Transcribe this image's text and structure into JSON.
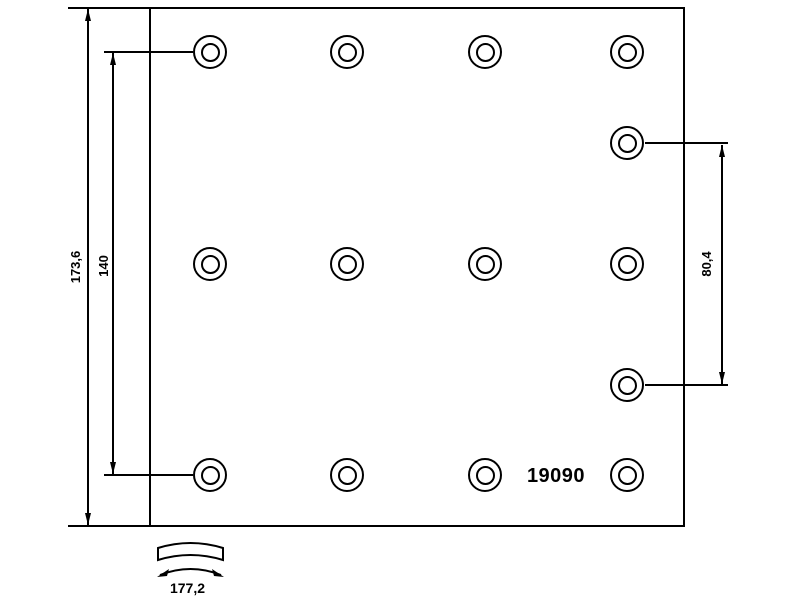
{
  "drawing": {
    "type": "brake-lining-technical-drawing",
    "part_number": "19090",
    "dimensions": {
      "overall_height": "173,6",
      "hole_span_vertical": "140",
      "right_hole_span": "80,4",
      "arc_length": "177,2"
    },
    "colors": {
      "line": "#000000",
      "background": "#ffffff"
    },
    "hole_outer_diameter_px": 34,
    "hole_inner_diameter_px": 19,
    "holes": [
      {
        "x": 210,
        "y": 52
      },
      {
        "x": 347,
        "y": 52
      },
      {
        "x": 485,
        "y": 52
      },
      {
        "x": 627,
        "y": 52
      },
      {
        "x": 627,
        "y": 143
      },
      {
        "x": 210,
        "y": 264
      },
      {
        "x": 347,
        "y": 264
      },
      {
        "x": 485,
        "y": 264
      },
      {
        "x": 627,
        "y": 264
      },
      {
        "x": 627,
        "y": 385
      },
      {
        "x": 210,
        "y": 475
      },
      {
        "x": 347,
        "y": 475
      },
      {
        "x": 485,
        "y": 475
      },
      {
        "x": 627,
        "y": 475
      }
    ]
  }
}
